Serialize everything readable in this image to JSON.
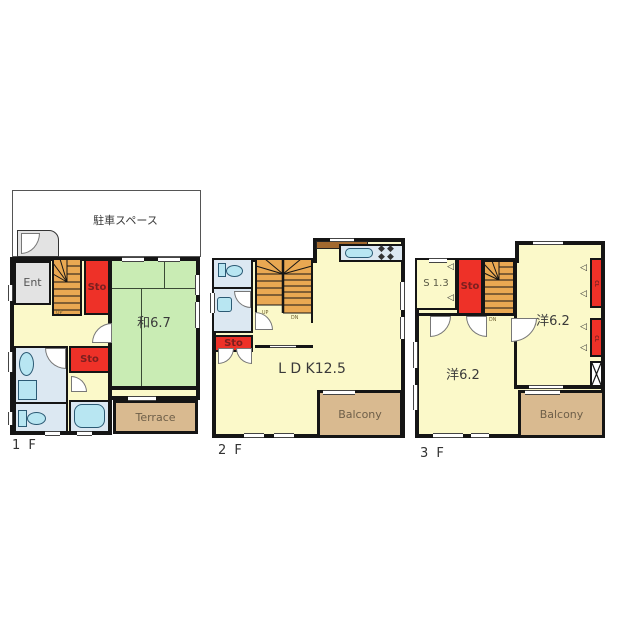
{
  "f1": {
    "floor_label": "1 F",
    "parking": "駐車スペース",
    "ent": "Ent",
    "sto_upper": "Sto",
    "sto_lower": "Sto",
    "tatami_room": "和6.7",
    "terrace": "Terrace",
    "stairs_up": "UP"
  },
  "f2": {
    "floor_label": "2 F",
    "sto": "Sto",
    "ldk": "L D K12.5",
    "balcony": "Balcony",
    "stairs_up": "UP",
    "stairs_dn": "DN"
  },
  "f3": {
    "floor_label": "3 F",
    "service_room": "S 1.3",
    "sto": "Sto",
    "bedroom_upper": "洋6.2",
    "bedroom_lower": "洋6.2",
    "closet1": "CL",
    "closet2": "CL",
    "balcony": "Balcony",
    "stairs_dn": "DN"
  },
  "colors": {
    "room_yellow": "#FBF9C9",
    "tatami_green": "#C9ECB4",
    "storage_red": "#EE3128",
    "stair_orange": "#E9A852",
    "wet_area_blue": "#DCE8F2",
    "fixture_cyan": "#B8E6F2",
    "outdoor_tan": "#D9BA90",
    "entry_gray": "#E3E3E3",
    "counter_brown": "#A2692F",
    "wall_black": "#151515"
  }
}
